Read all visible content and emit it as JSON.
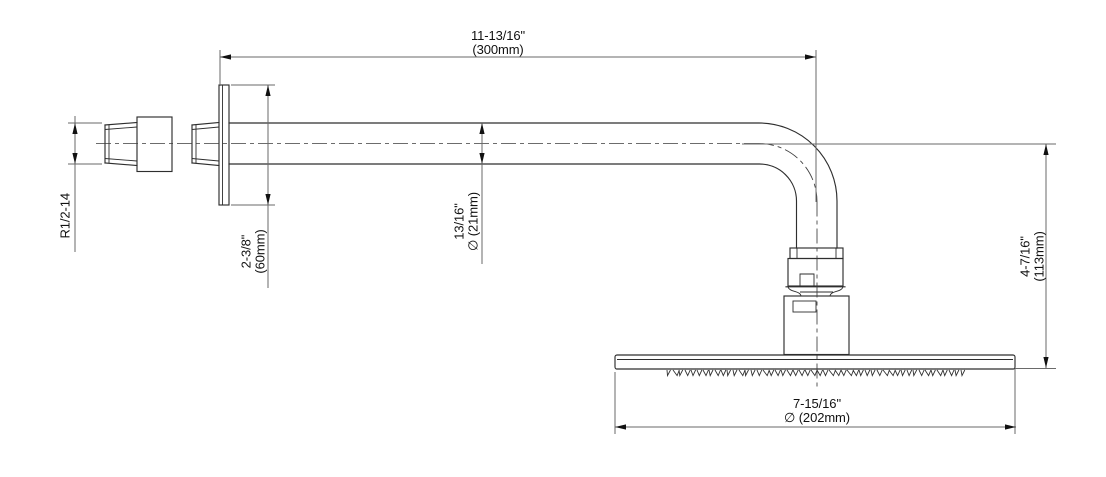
{
  "drawing": {
    "type": "technical-dimension-drawing",
    "subject": "wall-mount shower arm with round rain shower head, side elevation"
  },
  "dims": {
    "arm": {
      "in": "11-13/16\"",
      "mm": "(300mm)"
    },
    "thread": {
      "label": "R1/2-14"
    },
    "flange": {
      "in": "2-3/8\"",
      "mm": "(60mm)"
    },
    "pipe": {
      "in": "13/16\"",
      "mm": "∅ (21mm)"
    },
    "drop": {
      "in": "4-7/16\"",
      "mm": "(113mm)"
    },
    "head": {
      "in": "7-15/16\"",
      "mm": "∅ (202mm)"
    }
  },
  "colors": {
    "background": "#ffffff",
    "part_line": "#2e2e2e",
    "dim_line": "#6a6a6a",
    "text": "#111111"
  }
}
